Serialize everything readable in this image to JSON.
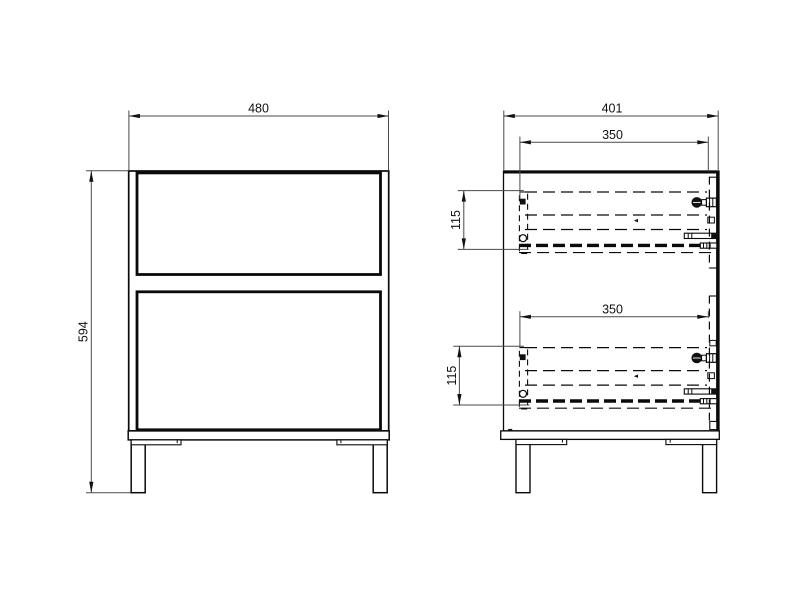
{
  "drawing_type": "furniture-technical-drawing",
  "dims": {
    "front_width": "480",
    "front_height": "594",
    "side_depth": "401",
    "upper_slide_length": "350",
    "lower_slide_length": "350",
    "upper_slide_height": "115",
    "lower_slide_height": "115"
  },
  "colors": {
    "background": "#ffffff",
    "geometry_line": "#0a0a0a",
    "dimension_line": "#4a4a4a",
    "text": "#111111"
  }
}
